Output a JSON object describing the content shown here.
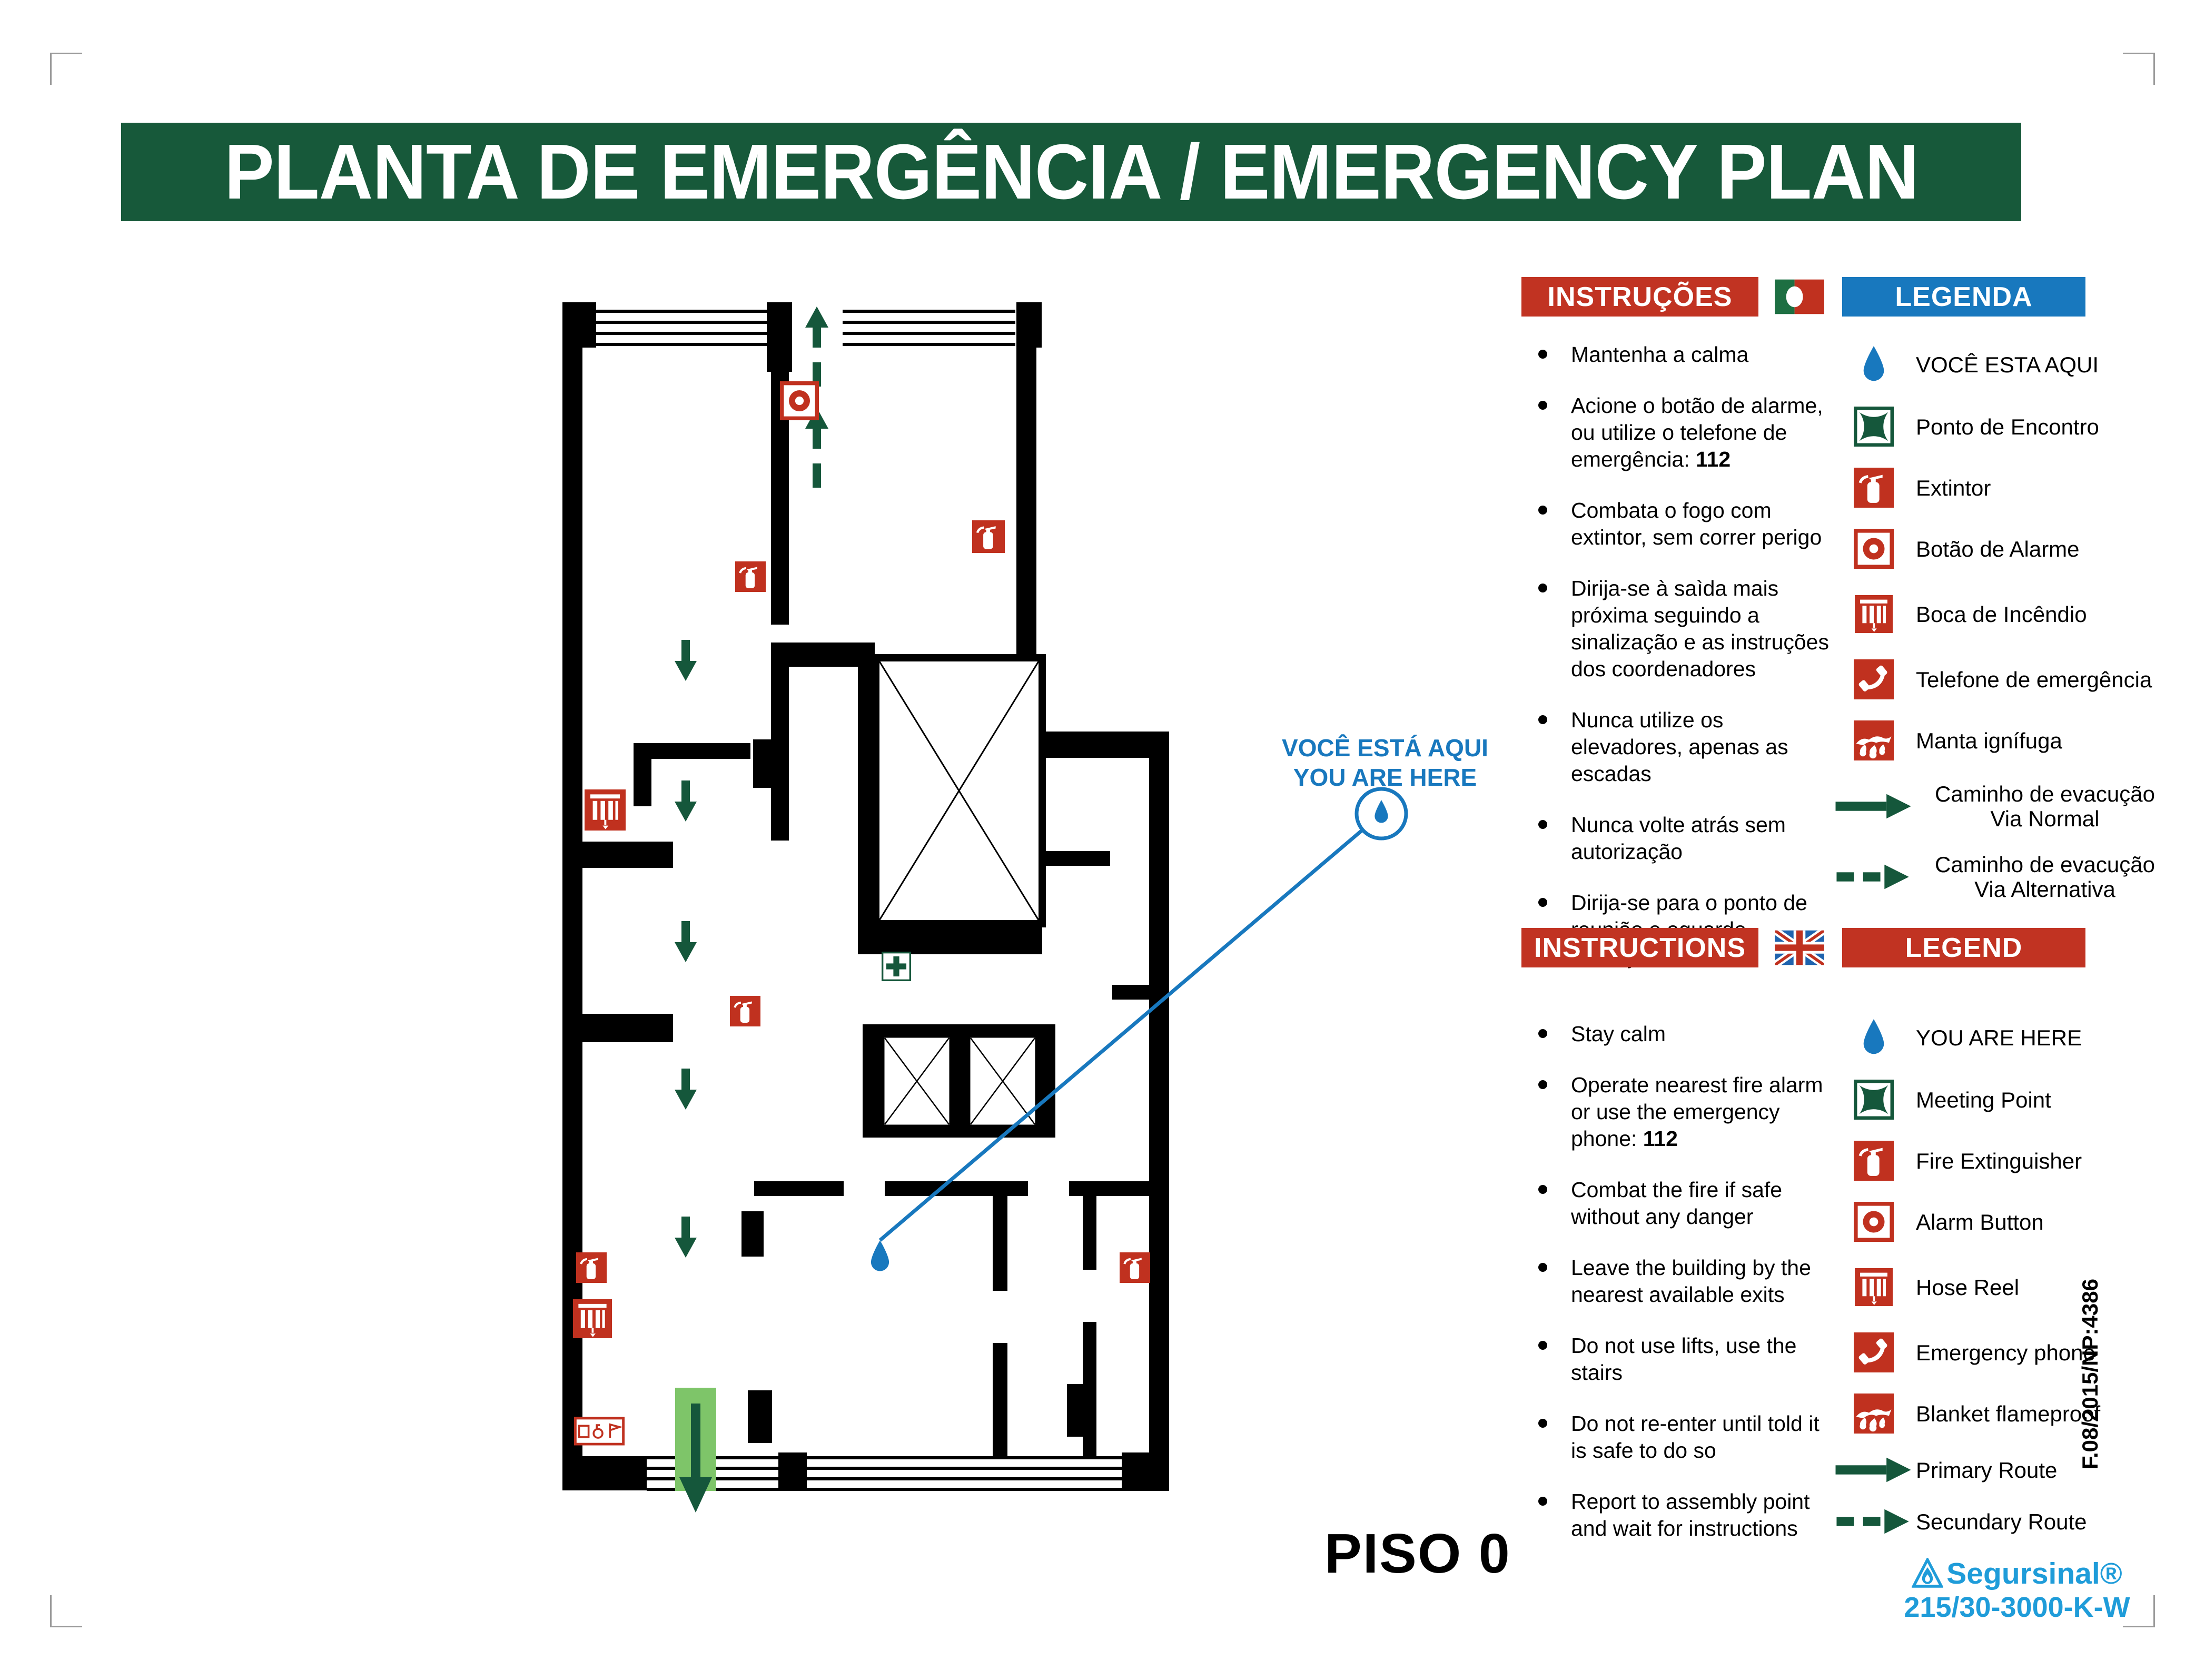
{
  "title": "PLANTA DE EMERGÊNCIA / EMERGENCY PLAN",
  "floor_label": "PISO 0",
  "callout": {
    "pt": "VOCÊ ESTÁ AQUI",
    "en": "YOU ARE HERE"
  },
  "pt": {
    "instructions_header": "INSTRUÇÕES",
    "legend_header": "LEGENDA",
    "instructions": [
      {
        "pre": "Mantenha a calma",
        "bold": ""
      },
      {
        "pre": "Acione o botão de alarme, ou utilize o telefone de emergência: ",
        "bold": "112"
      },
      {
        "pre": "Combata o fogo com extintor, sem correr perigo",
        "bold": ""
      },
      {
        "pre": "Dirija-se à saìda mais próxima seguindo a sinalização e as instruções dos coordenadores",
        "bold": ""
      },
      {
        "pre": "Nunca utilize os elevadores, apenas as escadas",
        "bold": ""
      },
      {
        "pre": "Nunca volte atrás sem autorização",
        "bold": ""
      },
      {
        "pre": "Dirija-se para o ponto de reunião e aguarde instruções",
        "bold": ""
      }
    ],
    "legend": [
      {
        "label": "VOCÊ ESTA AQUI",
        "label2": ""
      },
      {
        "label": "Ponto de Encontro",
        "label2": ""
      },
      {
        "label": "Extintor",
        "label2": ""
      },
      {
        "label": "Botão de Alarme",
        "label2": ""
      },
      {
        "label": "Boca de Incêndio",
        "label2": ""
      },
      {
        "label": "Telefone de emergência",
        "label2": ""
      },
      {
        "label": "Manta ignífuga",
        "label2": ""
      },
      {
        "label": "Caminho de evacução",
        "label2": "Via Normal"
      },
      {
        "label": "Caminho de evacução",
        "label2": "Via Alternativa"
      }
    ]
  },
  "en": {
    "instructions_header": "INSTRUCTIONS",
    "legend_header": "LEGEND",
    "instructions": [
      {
        "pre": "Stay calm",
        "bold": ""
      },
      {
        "pre": "Operate nearest fire alarm or use the emergency phone: ",
        "bold": "112"
      },
      {
        "pre": "Combat the fire if safe without any danger",
        "bold": ""
      },
      {
        "pre": "Leave the building by the nearest available exits",
        "bold": ""
      },
      {
        "pre": "Do not use lifts, use the stairs",
        "bold": ""
      },
      {
        "pre": "Do not re-enter until told it is safe to do so",
        "bold": ""
      },
      {
        "pre": "Report to assembly point and wait for instructions",
        "bold": ""
      }
    ],
    "legend": [
      {
        "label": "YOU ARE HERE",
        "label2": ""
      },
      {
        "label": "Meeting Point",
        "label2": ""
      },
      {
        "label": "Fire Extinguisher",
        "label2": ""
      },
      {
        "label": "Alarm Button",
        "label2": ""
      },
      {
        "label": "Hose Reel",
        "label2": ""
      },
      {
        "label": "Emergency phone",
        "label2": ""
      },
      {
        "label": "Blanket flameproof",
        "label2": ""
      },
      {
        "label": "Primary Route",
        "label2": ""
      },
      {
        "label": "Secundary Route",
        "label2": ""
      }
    ]
  },
  "footer": {
    "brand": "Segursinal®",
    "product_code": "215/30-3000-K-W",
    "doc_code": "F.08/2015/NP:4386"
  },
  "colors": {
    "banner_green": "#17593A",
    "header_red": "#C13322",
    "header_blue": "#1878BE",
    "icon_red": "#C0311F",
    "route_green": "#15573B",
    "exit_band_green": "#7EC569",
    "marker_blue": "#1878BE",
    "brand_blue": "#1F9CD9",
    "wall_black": "#000000"
  }
}
